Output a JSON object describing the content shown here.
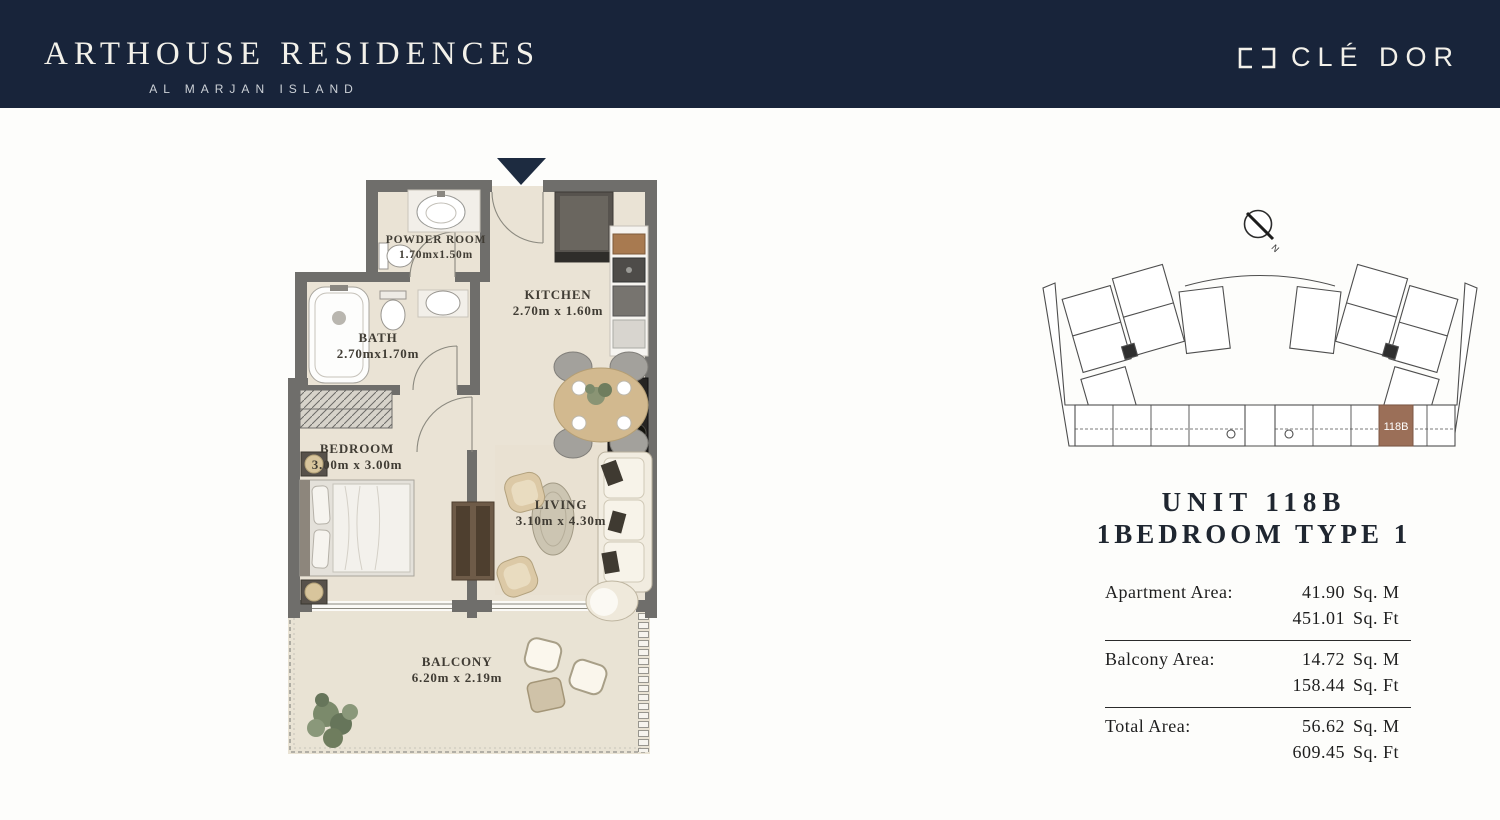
{
  "header": {
    "title": "ARTHOUSE RESIDENCES",
    "subtitle": "AL MARJAN ISLAND",
    "brand": "CLÉ DOR",
    "bg_color": "#18243a"
  },
  "floor_plan": {
    "entry_marker": "down-arrow",
    "rooms": [
      {
        "name": "POWDER ROOM",
        "dims": "1.70mx1.50m"
      },
      {
        "name": "BATH",
        "dims": "2.70mx1.70m"
      },
      {
        "name": "KITCHEN",
        "dims": "2.70m x 1.60m"
      },
      {
        "name": "BEDROOM",
        "dims": "3.00m x 3.00m"
      },
      {
        "name": "LIVING",
        "dims": "3.10m x 4.30m"
      },
      {
        "name": "BALCONY",
        "dims": "6.20m x 2.19m"
      }
    ],
    "wall_color": "#6f6e6b",
    "floor_color": "#eae3d5"
  },
  "key_plan": {
    "highlighted_unit": "118B",
    "compass_label": "N",
    "highlight_color": "#9b6f58"
  },
  "unit_info": {
    "title": "UNIT 118B",
    "subtitle": "1BEDROOM TYPE 1"
  },
  "area_table": {
    "rows": [
      {
        "label": "Apartment Area:",
        "sqm": "41.90",
        "sqm_unit": "Sq. M",
        "sqft": "451.01",
        "sqft_unit": "Sq. Ft"
      },
      {
        "label": "Balcony Area:",
        "sqm": "14.72",
        "sqm_unit": "Sq. M",
        "sqft": "158.44",
        "sqft_unit": "Sq. Ft"
      },
      {
        "label": "Total Area:",
        "sqm": "56.62",
        "sqm_unit": "Sq. M",
        "sqft": "609.45",
        "sqft_unit": "Sq. Ft"
      }
    ]
  }
}
